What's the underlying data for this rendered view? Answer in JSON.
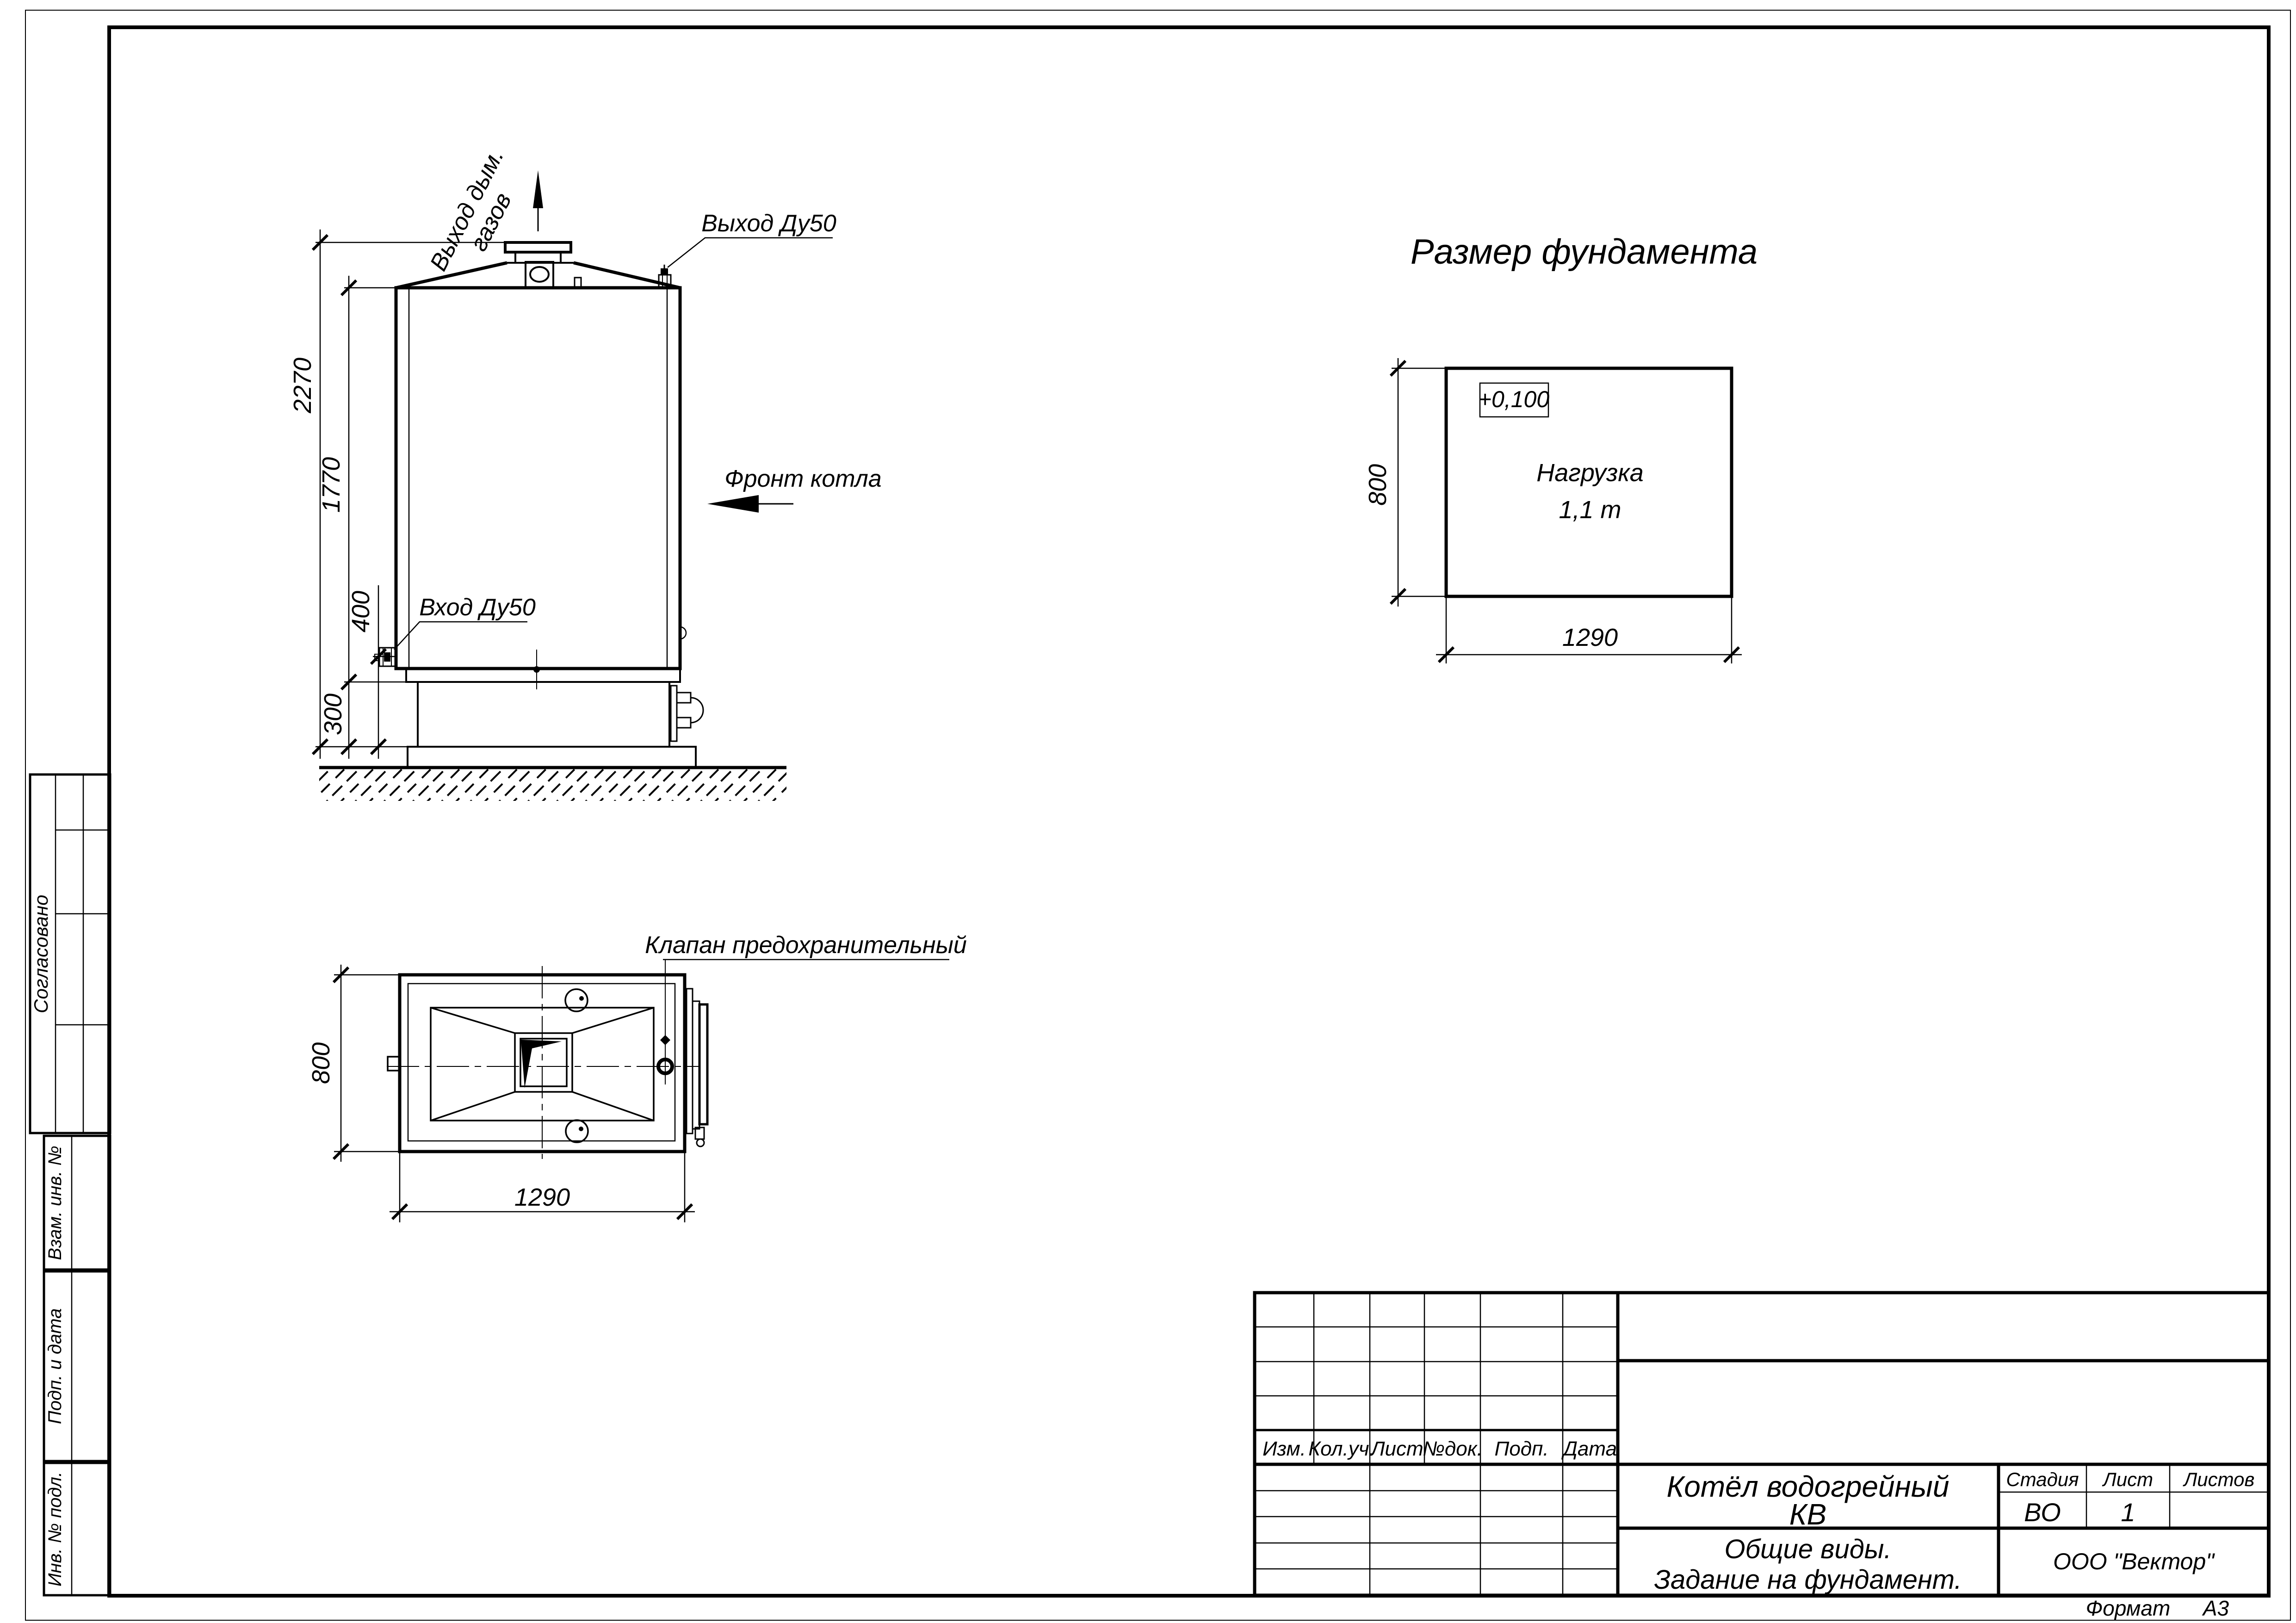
{
  "colors": {
    "line": "#000000",
    "background": "#ffffff"
  },
  "drawing": {
    "front_view": {
      "flue_label_line1": "Выход дым.",
      "flue_label_line2": "газов",
      "outlet_label": "Выход Ду50",
      "inlet_label": "Вход Ду50",
      "front_label": "Фронт котла",
      "dim_overall": "2270",
      "dim_body": "1770",
      "dim_inlet": "400",
      "dim_base": "300"
    },
    "plan_view": {
      "safety_valve_label": "Клапан предохранительный",
      "dim_depth": "800",
      "dim_width": "1290"
    },
    "foundation": {
      "title": "Размер фундамента",
      "level_mark": "+0,100",
      "load_line1": "Нагрузка",
      "load_line2": "1,1 т",
      "dim_depth": "800",
      "dim_width": "1290"
    }
  },
  "title_block": {
    "revision_headers": [
      "Изм.",
      "Кол.уч.",
      "Лист",
      "№док.",
      "Подп.",
      "Дата"
    ],
    "doc_name_line1": "Котёл водогрейный",
    "doc_name_line2": "КВ",
    "doc_type_line1": "Общие виды.",
    "doc_type_line2": "Задание на фундамент.",
    "stage_label": "Стадия",
    "sheet_label": "Лист",
    "sheets_label": "Листов",
    "stage_value": "ВО",
    "sheet_value": "1",
    "company": "ООО \"Вектор\"",
    "format_label": "Формат",
    "format_value": "А3"
  },
  "side_bar": {
    "approved": "Согласовано",
    "replace_inv": "Взам. инв. №",
    "sign_date": "Подп. и дата",
    "inv_orig": "Инв. № подл."
  }
}
